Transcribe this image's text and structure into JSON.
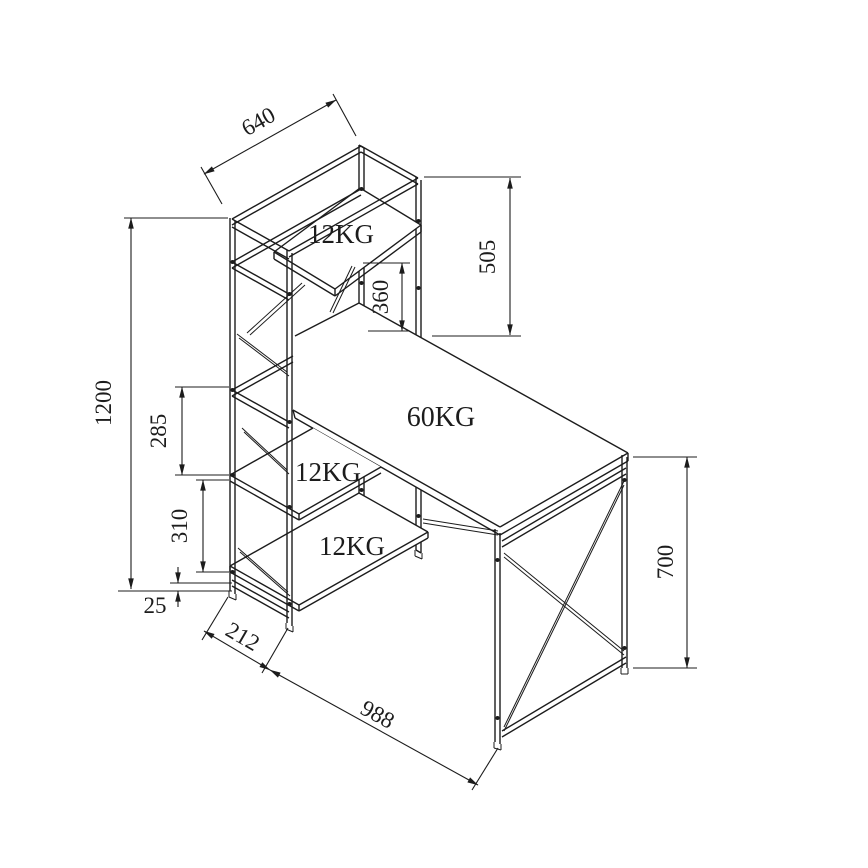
{
  "drawing": {
    "type": "isometric technical line drawing",
    "subject": "computer desk with 4-tier side shelf tower",
    "line_color": "#1c1c1c",
    "background_color": "#ffffff"
  },
  "dimensions": {
    "shelf_width": "640",
    "upper_section_height": "505",
    "desk_to_top_shelf": "360",
    "total_height": "1200",
    "upper_shelf_spacing": "285",
    "lower_shelf_spacing": "310",
    "base_clearance": "25",
    "tower_depth": "212",
    "desk_length": "988",
    "desk_height": "700"
  },
  "load_capacities": {
    "top_shelf": "12KG",
    "desktop": "60KG",
    "middle_shelf": "12KG",
    "bottom_shelf": "12KG"
  }
}
